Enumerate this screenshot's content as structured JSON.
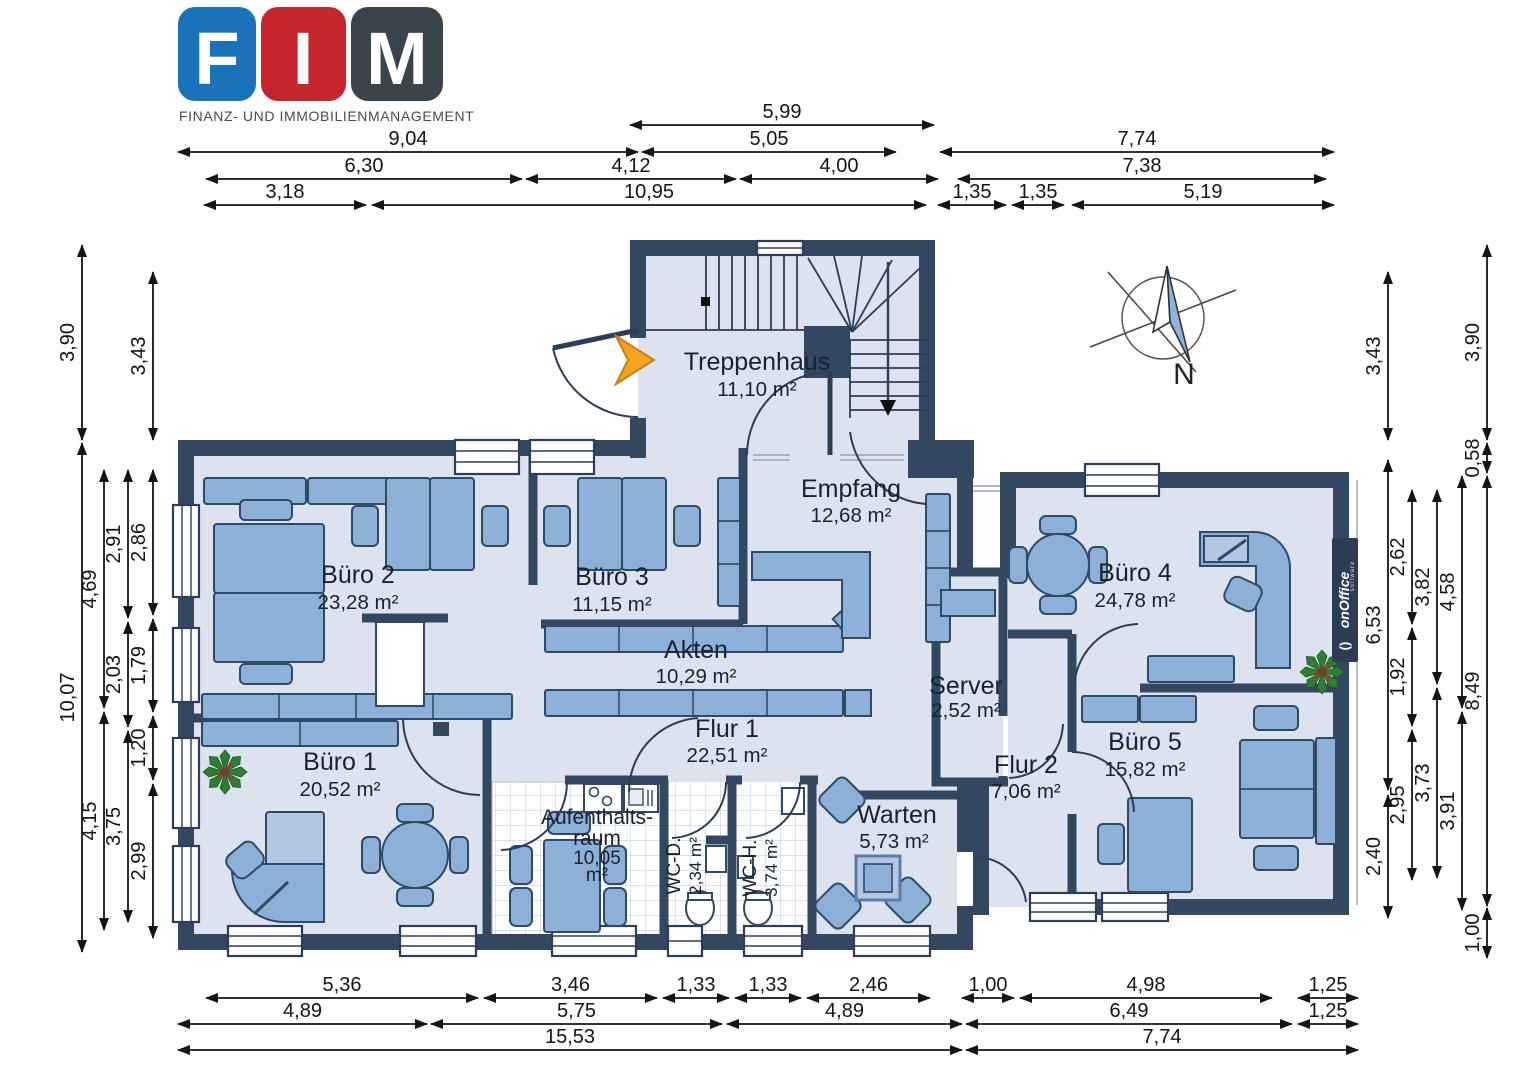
{
  "logo": {
    "letters": [
      "F",
      "I",
      "M"
    ],
    "letter_colors": [
      "#1a72b9",
      "#c5262c",
      "#3a454b"
    ],
    "subtitle": "FINANZ- UND IMMOBILIENMANAGEMENT"
  },
  "compass": {
    "north_label": "N"
  },
  "watermark": {
    "brand": "onOffice",
    "sub": "software"
  },
  "colors": {
    "wall": "#344761",
    "floor": "#dce3ee",
    "furniture": "#8db0d9",
    "accent_arrow": "#f6a41f"
  },
  "rooms": {
    "treppenhaus": {
      "name": "Treppenhaus",
      "area": "11,10 m²"
    },
    "empfang": {
      "name": "Empfang",
      "area": "12,68 m²"
    },
    "buero1": {
      "name": "Büro 1",
      "area": "20,52 m²"
    },
    "buero2": {
      "name": "Büro 2",
      "area": "23,28 m²"
    },
    "buero3": {
      "name": "Büro 3",
      "area": "11,15 m²"
    },
    "buero4": {
      "name": "Büro 4",
      "area": "24,78 m²"
    },
    "buero5": {
      "name": "Büro 5",
      "area": "15,82 m²"
    },
    "akten": {
      "name": "Akten",
      "area": "10,29 m²"
    },
    "server": {
      "name": "Server",
      "area": "2,52 m²"
    },
    "flur1": {
      "name": "Flur 1",
      "area": "22,51 m²"
    },
    "flur2": {
      "name": "Flur 2",
      "area": "7,06 m²"
    },
    "aufenthaltsraum": {
      "name_line1": "Aufenthalts-",
      "name_line2": "raum",
      "area_line1": "10,05",
      "area_line2": "m²"
    },
    "wc_damen": {
      "name": "WC-D.",
      "area": "2,34 m²"
    },
    "wc_herren": {
      "name": "WC-H.",
      "area": "3,74 m²"
    },
    "warten": {
      "name": "Warten",
      "area": "5,73 m²"
    }
  },
  "dimensions": {
    "top": [
      [
        "5,99"
      ],
      [
        "9,04",
        "5,05",
        "7,74"
      ],
      [
        "6,30",
        "4,12",
        "4,00",
        "7,38"
      ],
      [
        "3,18",
        "10,95",
        "1,35",
        "1,35",
        "5,19"
      ]
    ],
    "bottom": [
      [
        "5,36",
        "3,46",
        "1,33",
        "1,33",
        "2,46",
        "1,00",
        "4,98",
        "1,25"
      ],
      [
        "4,89",
        "5,75",
        "4,89",
        "6,49",
        "1,25"
      ],
      [
        "15,53",
        "7,74"
      ]
    ],
    "left": [
      [
        "3,90",
        "10,07"
      ],
      [
        "4,69",
        "4,15"
      ],
      [
        "2,91",
        "2,03",
        "3,75"
      ],
      [
        "3,43",
        "2,86",
        "1,79",
        "1,20",
        "2,99"
      ]
    ],
    "right": [
      [
        "3,43",
        "6,53",
        "2,40"
      ],
      [
        "2,62",
        "1,92",
        "2,95"
      ],
      [
        "3,82",
        "3,73"
      ],
      [
        "4,58",
        "3,91"
      ],
      [
        "3,90",
        "0,58",
        "8,49",
        "1,00"
      ]
    ]
  }
}
